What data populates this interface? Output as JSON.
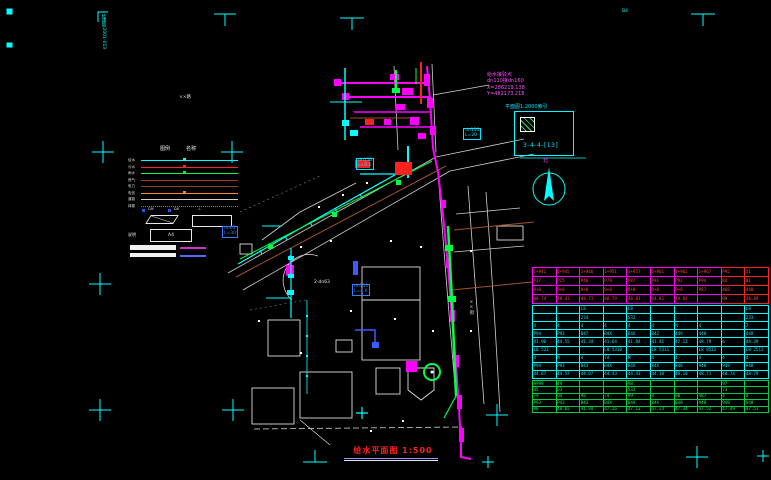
{
  "title": {
    "text": "给水平面图 1:500"
  },
  "stamp": {
    "vertical_text": "桂建审2001-013",
    "sheet_code": "B4"
  },
  "index_box": {
    "caption": "平面图1:2000索引",
    "code": "3-4-4-[13]",
    "accent": "#00ffff"
  },
  "north": {
    "label": "北"
  },
  "connection_note": {
    "line1": "给水接驳点",
    "line2": "dn110接dn160",
    "line3": "X=286219.138",
    "line4": "Y=482173.218"
  },
  "legend": {
    "headers": [
      "图例",
      "名称"
    ],
    "lines": [
      {
        "label": "给水",
        "color": "#00ffff",
        "dotted": false
      },
      {
        "label": "污水",
        "color": "#ff2222",
        "dotted": false
      },
      {
        "label": "雨水",
        "color": "#00ff44",
        "dotted": false
      },
      {
        "label": "燃气",
        "color": "#aa3322",
        "dotted": false
      },
      {
        "label": "电力",
        "color": "#884422",
        "dotted": false
      },
      {
        "label": "电信",
        "color": "#ff8822",
        "dotted": false
      },
      {
        "label": "道路",
        "color": "#cfcfcf",
        "dotted": false
      },
      {
        "label": "绿篱",
        "color": "#00cc44",
        "dotted": true
      }
    ],
    "symbols": {
      "item1": "CM",
      "item2": "DX",
      "angle": "∠",
      "note_label": "说明",
      "box_label": "A4"
    }
  },
  "map_labels": [
    {
      "id": "dn110-l90",
      "text": "dn110",
      "text2": "L=9.0",
      "x": 356,
      "y": 158,
      "color": "#00e5ff",
      "boxed": true
    },
    {
      "id": "dn110-l20",
      "text": "dn110",
      "text2": "L=20",
      "x": 463,
      "y": 128,
      "color": "#00e5ff",
      "boxed": true
    },
    {
      "id": "dn63-l30",
      "text": "dn63",
      "text2": "L=30",
      "x": 222,
      "y": 226,
      "color": "#3a7bff",
      "boxed": true
    },
    {
      "id": "dn110-l40",
      "text": "dn110",
      "text2": "L=4.0",
      "x": 352,
      "y": 284,
      "color": "#3a7bff",
      "boxed": true
    },
    {
      "id": "2dn63",
      "text": "2-dn63",
      "x": 314,
      "y": 281,
      "color": "#e8e8e8",
      "boxed": false
    },
    {
      "id": "street-1",
      "text": "××路",
      "x": 179,
      "y": 96,
      "color": "#dddddd",
      "boxed": false
    },
    {
      "id": "street-2",
      "text": "××街",
      "x": 468,
      "y": 300,
      "color": "#dddddd",
      "boxed": false,
      "vertical": true
    },
    {
      "id": "sheet-code",
      "text": "B4",
      "x": 622,
      "y": 10,
      "color": "#00ffff",
      "boxed": false
    },
    {
      "id": "stamp-vert",
      "text": "桂建审2001-013",
      "x": 100,
      "y": 14,
      "color": "#00ffff",
      "boxed": false,
      "vertical": true
    }
  ],
  "table": {
    "sections": [
      {
        "name": "upper",
        "border": "#ff00ff",
        "text": "#ff4040",
        "accent_border": "#ff2020",
        "rows": [
          [
            "1+941",
            "1+945",
            "1+946",
            "1+951",
            "1+957",
            "1+961",
            "1+962",
            "1+967",
            "P92",
            "51"
          ],
          [
            "P17",
            "P25",
            "P46",
            "P79",
            "P87",
            "P91",
            "P92",
            "P94",
            "84",
            "01"
          ],
          [
            "9+8",
            "9+8",
            "9+8",
            "9+8",
            "9+8",
            "9+8",
            "9+8",
            "P87",
            "468",
            "448"
          ],
          [
            "48.74",
            "48.43",
            "48.73",
            "48.79",
            "48.81",
            "44.82",
            "44.04",
            "",
            "98",
            "48.09"
          ]
        ]
      },
      {
        "name": "middle",
        "border": "#00ffff",
        "text": "#00e5ff",
        "rows": [
          [
            "",
            "",
            "L8",
            "",
            "L8",
            "",
            "",
            "",
            "",
            "L8"
          ],
          [
            "",
            "",
            "234",
            "",
            "532",
            "",
            "",
            "",
            "",
            "233"
          ],
          [
            "4",
            "4",
            "4",
            "4",
            "4",
            "4",
            "M",
            "4",
            "",
            "7"
          ],
          [
            "P94",
            "P93",
            "B47",
            "B4X",
            "84X",
            "84Z",
            "449",
            "448",
            "",
            "448"
          ],
          [
            "41.96",
            "44.55",
            "41.34",
            "41.64",
            "41.94",
            "41.41",
            "47.11",
            "48.79",
            "m",
            "48.39"
          ],
          [
            "L8 523",
            "",
            "",
            "L8 5310",
            "",
            "L8 5311",
            "",
            "L8 8512",
            "",
            "L8 2512"
          ],
          [
            "4",
            "M",
            "4",
            "74",
            "M",
            "4",
            "4",
            "4",
            "4",
            "4"
          ],
          [
            "P94",
            "P93",
            "B43",
            "B4X",
            "84X",
            "84X",
            "848",
            "948",
            "948",
            "948"
          ],
          [
            "44.67",
            "44.57",
            "44.07",
            "44.43",
            "44.43",
            "44.10",
            "48.10",
            "48.71",
            "48.74",
            "48.79"
          ]
        ]
      },
      {
        "name": "lower",
        "border": "#00cc44",
        "text": "#00ff55",
        "rows": [
          [
            "9999",
            "49",
            "",
            "",
            "98",
            "",
            "",
            "",
            "97",
            ""
          ],
          [
            "45",
            "D3",
            "",
            "",
            "532",
            "",
            "",
            "",
            "73",
            ""
          ],
          [
            "79",
            "94",
            "98",
            "74",
            "99",
            "4",
            "90",
            "487",
            "4",
            "4"
          ],
          [
            "P93",
            "P43",
            "B43",
            "B4X",
            "84X",
            "84X",
            "848",
            "948",
            "948",
            "948"
          ],
          [
            "98",
            "48.65",
            "41.94",
            "47.26",
            "47.13",
            "47.24",
            "47.34",
            "47.52",
            "47.49",
            "47.51"
          ]
        ]
      }
    ]
  }
}
